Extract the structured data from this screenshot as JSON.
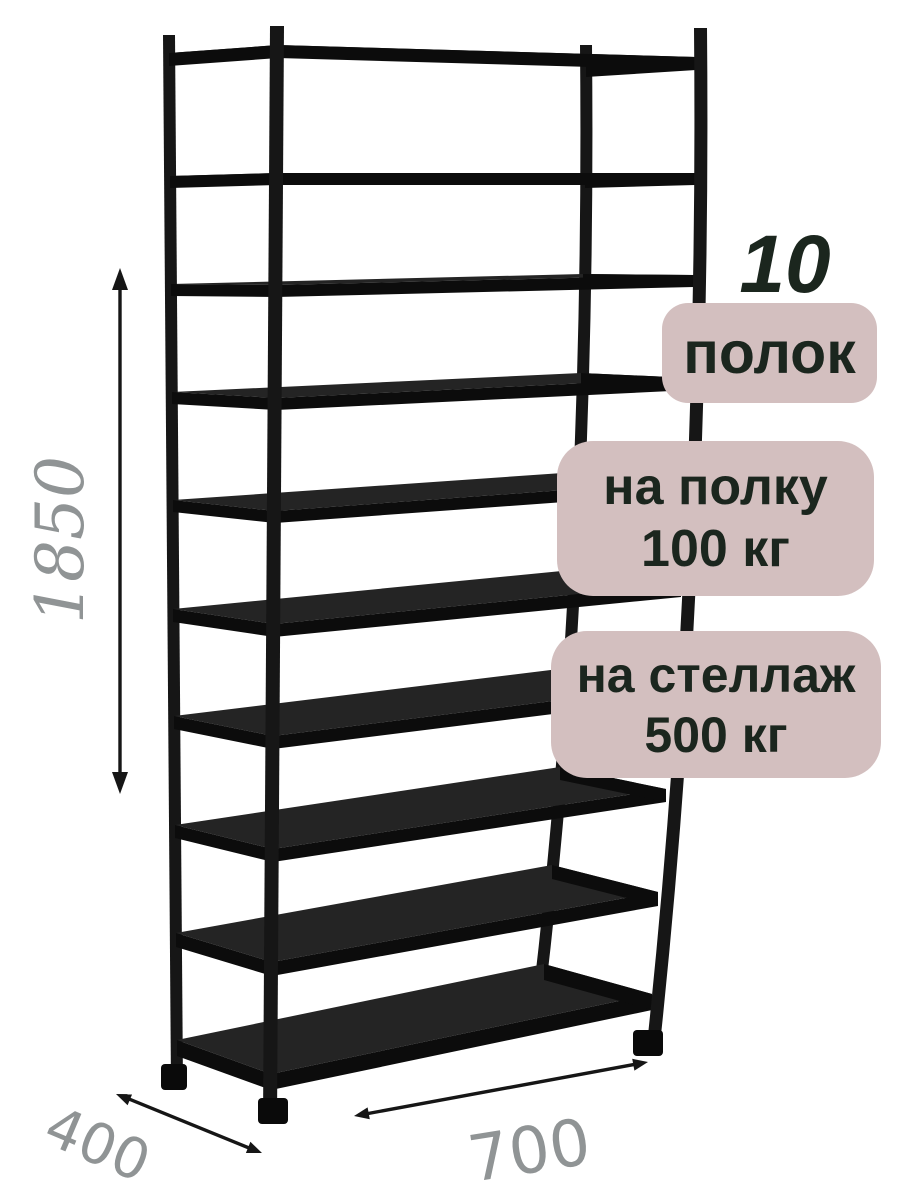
{
  "annotations": {
    "shelf_count_number": "10",
    "shelf_count_label": "полок",
    "shelf_load_line1": "на полку",
    "shelf_load_line2": "100 кг",
    "rack_load_line1": "на стеллаж",
    "rack_load_line2": "500 кг"
  },
  "dimensions": {
    "height_mm": "1850",
    "depth_mm": "400",
    "width_mm": "700"
  },
  "rack": {
    "shelf_count": 10
  },
  "colors": {
    "background": "#ffffff",
    "rack_black": "#161616",
    "badge_bg": "#d3bfbf",
    "badge_text": "#1b261e",
    "dim_text_gray": "#909495",
    "arrow_black": "#161616"
  }
}
